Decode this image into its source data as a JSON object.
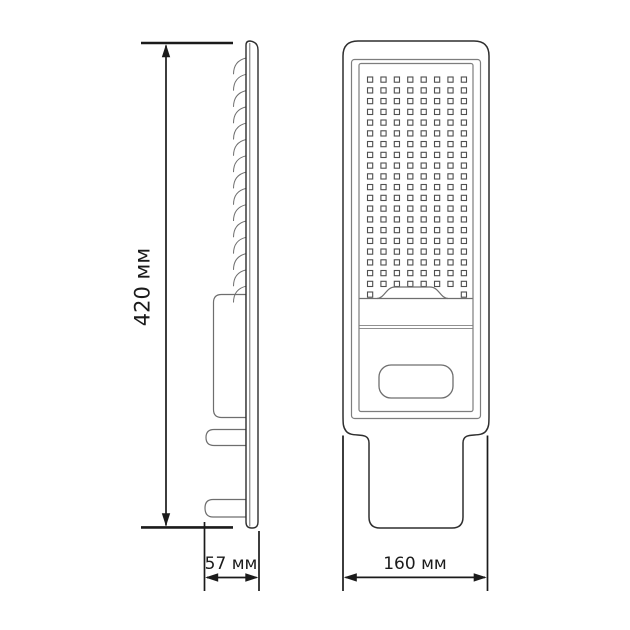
{
  "labels": {
    "height": "420 мм",
    "side_width": "57 мм",
    "front_width": "160 мм"
  },
  "drawing": {
    "description": "LED street light technical drawing, side view and front view",
    "fins": {
      "count": 15
    },
    "led_grid": {
      "columns": 8,
      "rows": 20,
      "partial_row_columns": [
        1,
        8
      ]
    },
    "colors": {
      "outline": "#2e2e2e",
      "detail": "#6e6e6e",
      "frame": "#7d7d7d",
      "grid": "#4f4f4f",
      "divider": "#909090",
      "dimension": "#1b1b1b"
    }
  }
}
